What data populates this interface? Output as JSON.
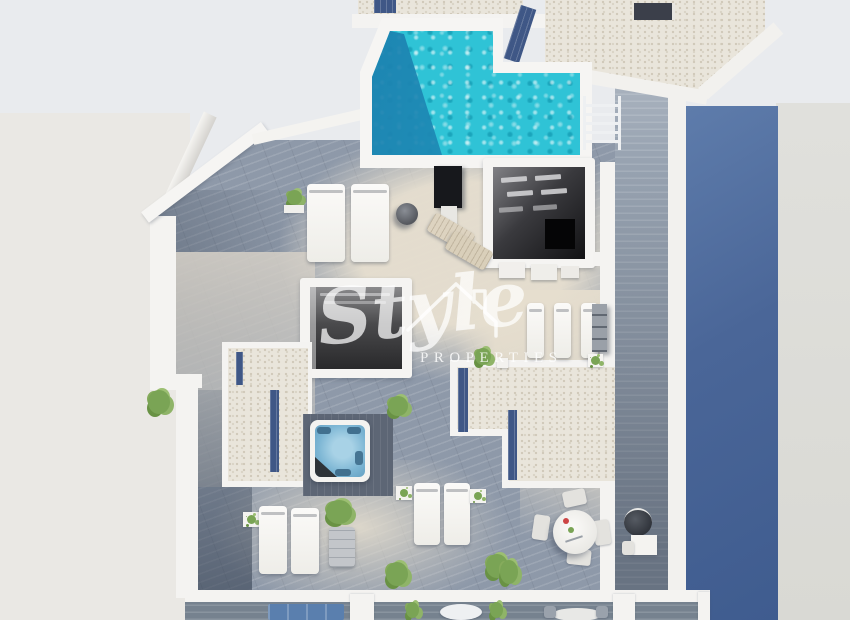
{
  "watermark": {
    "script": "Style",
    "caps": "PROPERTIES"
  },
  "scene": {
    "kind": "3d-aerial-architectural-render",
    "subject": "rooftop solarium floor plan of a modern villa",
    "features": [
      "swimming-pool",
      "hot-tub",
      "skylight-voids",
      "gravel-roof-sections",
      "sun-loungers",
      "outdoor-shower",
      "dining-set",
      "stairs",
      "lower-balconies"
    ]
  },
  "palette": {
    "background": "#e9ebee",
    "pool_water": "#2fc3d6",
    "pool_deep": "#1d82b2",
    "deck_wood": "#8e99a9",
    "sunlit_deck": "#ded7c8",
    "gravel": "#e9e5db",
    "solar_strip": "#3f5786",
    "facade_blue": "#4a6698",
    "white_wall": "#f4f3f1",
    "hot_tub_water": "#7db6d4",
    "foliage": "#7aa455",
    "shower_panel": "#17181c",
    "sofa_blue": "#5a7fae"
  }
}
